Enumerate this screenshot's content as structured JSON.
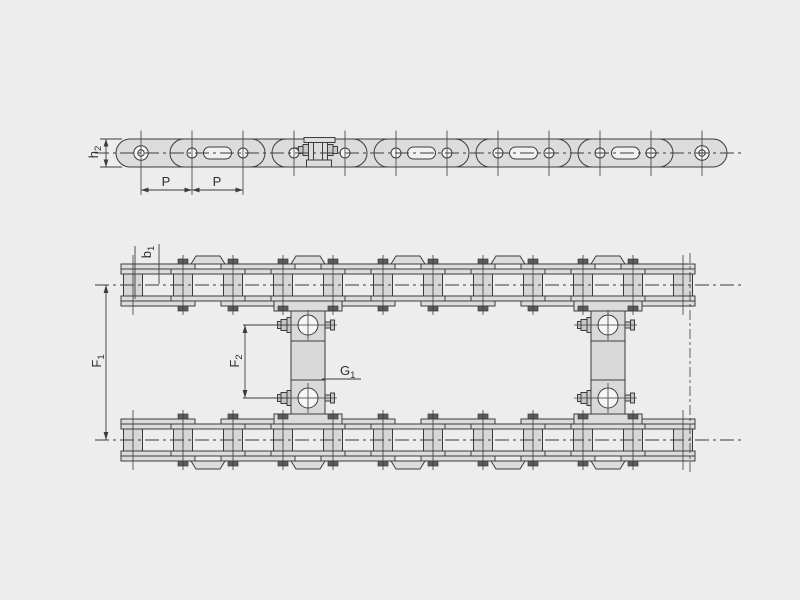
{
  "drawing": {
    "type": "roller-chain-with-attachments-technical-drawing",
    "views": 2
  },
  "labels": {
    "h2": {
      "base": "h",
      "sub": "2"
    },
    "pitch_left": {
      "base": "P",
      "sub": ""
    },
    "pitch_right": {
      "base": "P",
      "sub": ""
    },
    "b1": {
      "base": "b",
      "sub": "1"
    },
    "f1": {
      "base": "F",
      "sub": "1"
    },
    "f2": {
      "base": "F",
      "sub": "2"
    },
    "g1": {
      "base": "G",
      "sub": "1"
    }
  },
  "colors": {
    "background": "#ededed",
    "plate": "#dcdcdc",
    "roller": "#d6d6d6",
    "bar": "#d9d9d9",
    "hole": "#f6f6f6",
    "slot": "#f1f1f1",
    "line": "#3c3c3c",
    "dark": "#5c5c5c",
    "nut": "#c8c8c8",
    "text": "#2e2e2e"
  }
}
